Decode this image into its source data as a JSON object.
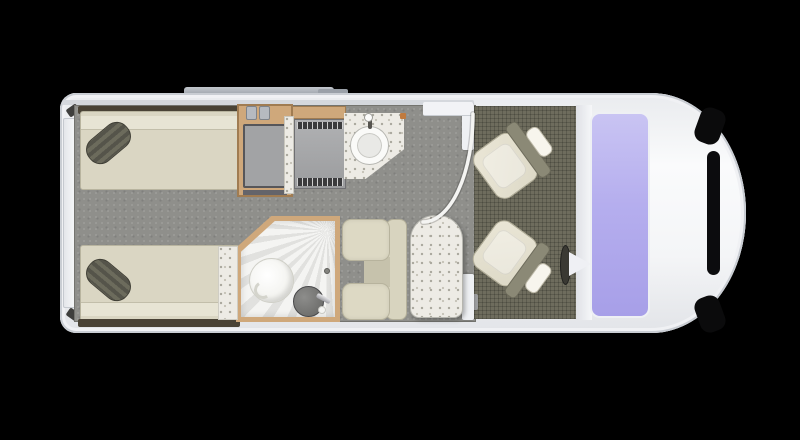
{
  "scene": {
    "type": "motorhome-floorplan",
    "view": "top-down plan",
    "vehicle_front": "right",
    "background": "black",
    "rooms": [
      {
        "name": "rear-bedroom",
        "items": [
          "twin-bed-top",
          "twin-bed-bottom",
          "pillow-top",
          "pillow-bottom",
          "wardrobe"
        ]
      },
      {
        "name": "kitchen",
        "items": [
          "hob-unit",
          "worktop",
          "round-sink",
          "tap"
        ]
      },
      {
        "name": "washroom",
        "items": [
          "shower-tray",
          "toilet",
          "washbasin",
          "basin-tap"
        ]
      },
      {
        "name": "lounge",
        "items": [
          "bench-seat",
          "pedestal-table"
        ]
      },
      {
        "name": "entry",
        "items": [
          "doorway",
          "door-swing-arc"
        ]
      },
      {
        "name": "cab",
        "items": [
          "passenger-swivel-seat",
          "driver-swivel-seat",
          "steering-wheel",
          "dashboard",
          "windscreen",
          "bonnet",
          "grille"
        ]
      }
    ],
    "exterior_items": [
      "awning-rail",
      "rear-door",
      "rear-door-handles",
      "roof-box"
    ]
  },
  "palette": {
    "bg": "#000000",
    "shell": "#f2f3f5",
    "shell-edge": "#c9cdd3",
    "chrome": "#ccd0d6",
    "awning": "#9aa0a8",
    "floor": "#8f8f8b",
    "cab-floor": "#6e6c5d",
    "wall-line": "#d5d8dd",
    "mattress": "#dad6c3",
    "mattress-band": "#e7e4d4",
    "bed-trim": "#4a4336",
    "pillow": "#5f5e50",
    "wood": "#cfa87b",
    "wood-dark": "#a07c52",
    "cabinet": "#a2a3a5",
    "cabinet-edge": "#56565a",
    "appliance": "#a6a7a9",
    "appliance-dark": "#3b3b3d",
    "terrazzo": "#edebe5",
    "terrazzo-dot": "#a9a79d",
    "shower": "#f4f4f2",
    "toilet": "#fbfbf9",
    "basin": "#6c6c6a",
    "bench": "#d8d4bf",
    "bench-edge": "#b4b09a",
    "table-top": "#eceae3",
    "seat-base": "#e8e4d4",
    "seat-head": "#f7f5ed",
    "seat-frame": "#8b8976",
    "windshield-top": "#c9c4f3",
    "windshield-bottom": "#a79fe8",
    "steering": "#3a3933",
    "dashboard": "#eef0f3",
    "grille": "#0c0c0e",
    "door-arc": "#f4f4f2"
  }
}
